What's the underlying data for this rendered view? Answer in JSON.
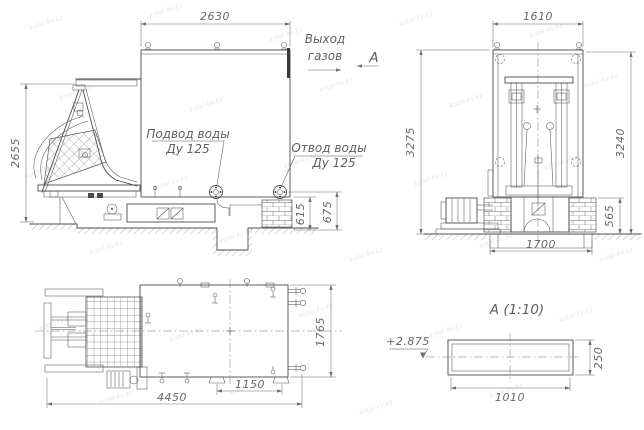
{
  "watermark": {
    "text": "kotel-kv.kz"
  },
  "side_view": {
    "dim_width_top": "2630",
    "dim_height_left": "2655",
    "dim_depth_1": "615",
    "dim_depth_2": "675",
    "water_inlet": {
      "line1": "Подвод воды",
      "line2": "Ду 125"
    },
    "water_outlet": {
      "line1": "Отвод воды",
      "line2": "Ду 125"
    },
    "gas_outlet": {
      "line1": "Выход",
      "line2": "газов"
    },
    "section_label": "А"
  },
  "front_view": {
    "dim_width_top": "1610",
    "dim_height_left": "3275",
    "dim_height_right": "3240",
    "dim_plinth": "565",
    "dim_foundation_width": "1700"
  },
  "plan_view": {
    "dim_length_total": "4450",
    "dim_support_spacing": "1150",
    "dim_width": "1765"
  },
  "section_view": {
    "title": "А (1:10)",
    "level_mark": "+2.875",
    "dim_width": "1010",
    "dim_height": "250"
  }
}
